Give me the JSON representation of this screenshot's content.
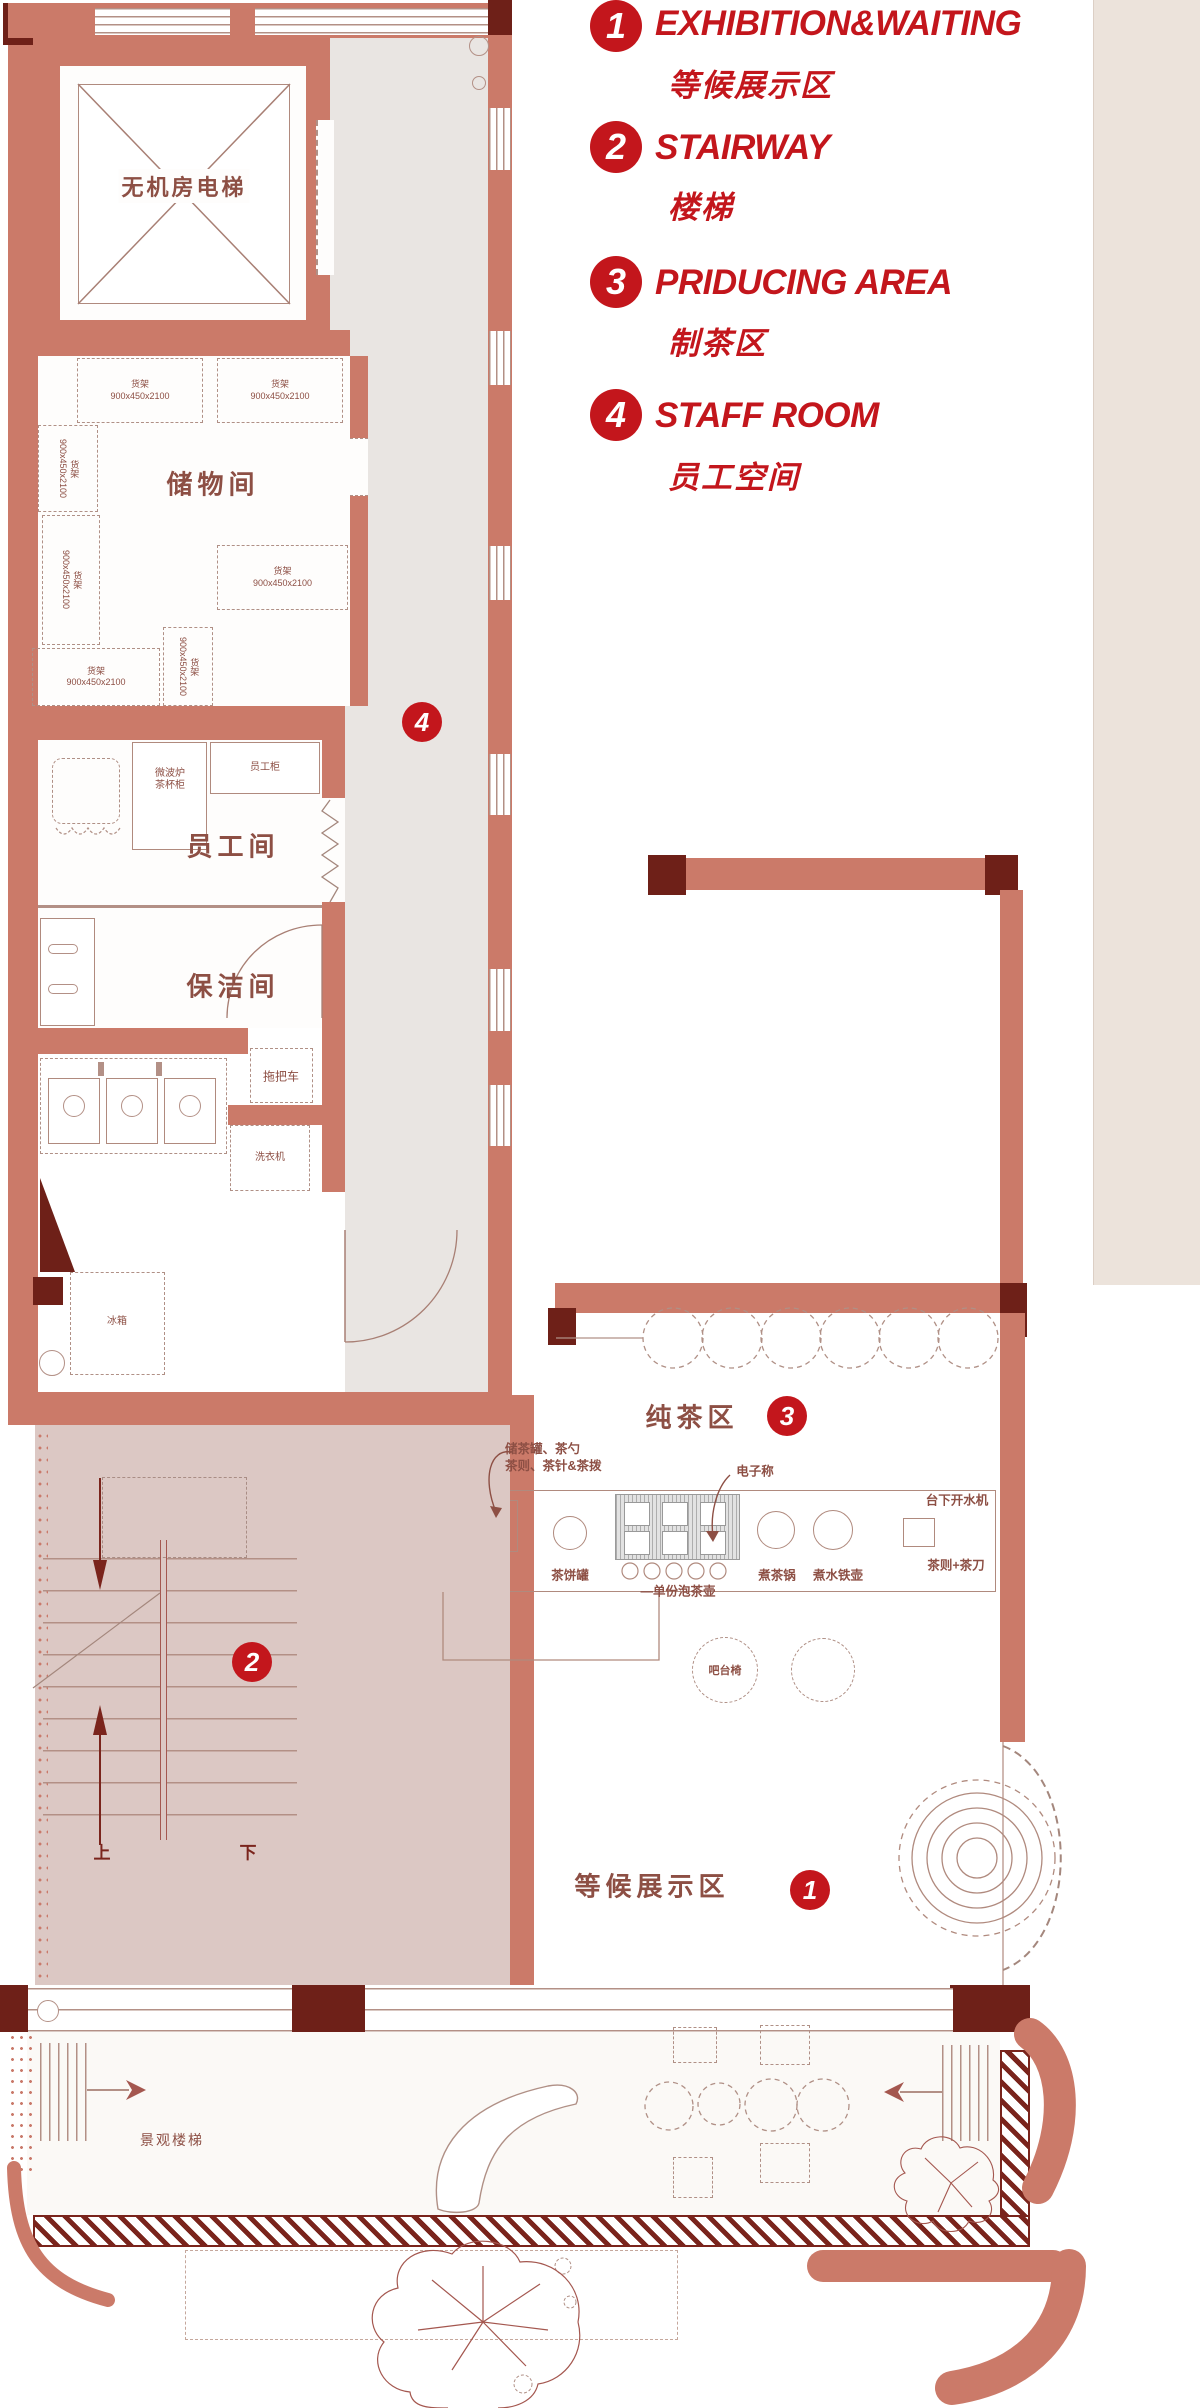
{
  "legend": {
    "items": [
      {
        "num": "1",
        "en": "EXHIBITION&WAITING",
        "zh": "等候展示区"
      },
      {
        "num": "2",
        "en": "STAIRWAY",
        "zh": "楼梯"
      },
      {
        "num": "3",
        "en": "PRIDUCING AREA",
        "zh": "制茶区"
      },
      {
        "num": "4",
        "en": "STAFF ROOM",
        "zh": "员工空间"
      }
    ]
  },
  "rooms": {
    "elevator": "无机房电梯",
    "storage": "储物间",
    "staff": "员工间",
    "cleaning": "保洁间",
    "pure_tea": "纯茶区",
    "waiting": "等候展示区",
    "landscape_stairs": "景观楼梯"
  },
  "markers": {
    "m1": "1",
    "m2": "2",
    "m3": "3",
    "m4": "4"
  },
  "furniture": {
    "shelf": "货架",
    "shelf_size": "900x450x2100",
    "microwave": "微波炉",
    "cup_cabinet": "茶杯柜",
    "staff_locker": "员工柜",
    "mop_cart": "拖把车",
    "washing_machine": "洗衣机",
    "fridge": "冰箱",
    "bar_chair": "吧台椅"
  },
  "counter": {
    "callout_jar_line1": "储茶罐、茶勺",
    "callout_jar_line2": "茶则、茶针&茶拨",
    "scale": "电子称",
    "tea_cake_jar": "茶饼罐",
    "single_teapot": "—单份泡茶壶",
    "tea_boil_pot": "煮茶锅",
    "iron_kettle": "煮水铁壶",
    "water_boiler": "台下开水机",
    "tea_scoop_knife": "茶则+茶刀"
  },
  "stairs": {
    "up": "上",
    "down": "下"
  },
  "colors": {
    "accent_red": "#c3161c",
    "wall_salmon": "#cb7a69",
    "wall_dark": "#6e2018",
    "stair_pink": "#dcc8c4",
    "corridor_gray": "#e9e5e2"
  }
}
